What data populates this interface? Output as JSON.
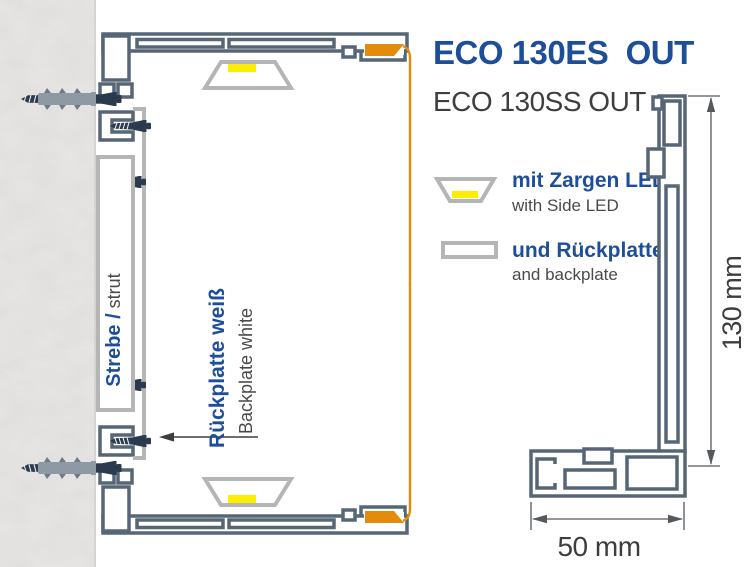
{
  "header": {
    "title": "ECO 130ES  OUT",
    "subtitle": "ECO 130SS OUT"
  },
  "legend": {
    "items": [
      {
        "icon": "side-led-icon",
        "label_de": "mit Zargen LED",
        "label_en": "with Side LED"
      },
      {
        "icon": "backplate-icon",
        "label_de": "und Rückplatte",
        "label_en": "and backplate"
      }
    ]
  },
  "annotations": {
    "strut_de": "Strebe /",
    "strut_en": " strut",
    "backplate_de": "Rückplatte weiß",
    "backplate_en": "Backplate white"
  },
  "dimensions": {
    "height_label": "130 mm",
    "width_label": "50 mm"
  },
  "colors": {
    "accent_blue": "#1d4e9a",
    "profile_slate": "#566676",
    "light_gray": "#b5b5b5",
    "led_yellow": "#fcee00",
    "face_orange": "#e28b0d",
    "screw_navy": "#2b3a4d",
    "text_gray": "#3e3e3e"
  }
}
